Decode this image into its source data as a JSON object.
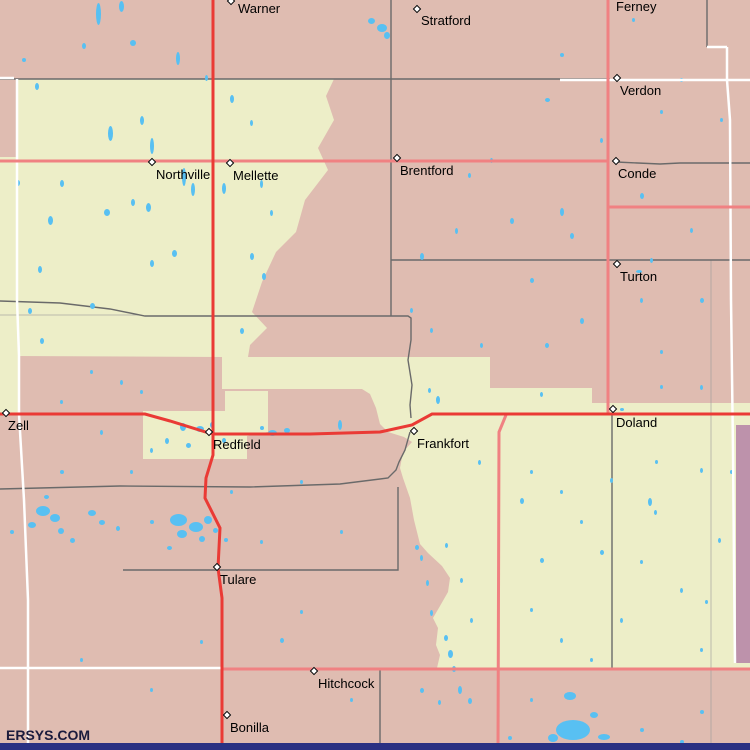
{
  "map": {
    "attribution": "ERSYS.COM",
    "width": 750,
    "height": 750,
    "colors": {
      "base_pink": "#dfbcb1",
      "yellow": "#edeec8",
      "purple": "#bd92ab",
      "water": "#58c0f2",
      "road_major": "#ea3a35",
      "road_secondary": "#f08182",
      "road_minor": "#ffffff",
      "boundary": "#6a6a6a",
      "boundary_faint": "#9a9a9a",
      "bottom_bar": "#2a3183",
      "label_text": "#000000"
    },
    "regions": {
      "yellow_main": "16,79 334,79 326,96 334,120 318,148 328,170 305,200 296,232 276,252 262,282 252,312 267,328 250,345 248,357 490,357 490,388 592,388 592,403 750,403 750,668 437,668 440,655 436,645 438,628 433,618 440,606 448,592 450,578 442,566 428,553 420,544 414,520 410,498 403,478 400,468 403,452 412,442 404,437 388,432 380,424 376,408 370,394 362,389 222,389 222,357 16,356",
      "left_yellow_sliver": "0,157 17,157 17,356 19,356 19,414 0,414",
      "redfield_patch": "143,411 225,411 225,391 268,391 268,432 247,436 247,459 143,459",
      "purple_strip": "736,425 750,425 750,663 736,663"
    },
    "boundaries_gray": [
      "0,79 610,79",
      "391,0 391,316",
      "0,301 60,303 110,309 145,316 408,316 411,318 411,340 408,360 412,385 410,405 411,418",
      "410,432 405,450 399,462 396,470 388,478 340,484 250,487 120,486 0,489",
      "123,570 398,570 398,487",
      "616,162 660,164 680,163 750,163",
      "391,260 750,260",
      "612,414 612,668",
      "380,668 380,750",
      "707,0 707,47"
    ],
    "boundaries_faint": [
      "711,260 711,750",
      "0,315 140,315"
    ],
    "roads_white": [
      "17,79 17,300 19,356 19,414",
      "19,414 24,500 28,600 28,750",
      "0,78 14,78",
      "560,80 750,80",
      "707,47 727,47",
      "727,47 727,80 730,120 731,300 733,450 734,560 735,663",
      "0,668 222,668"
    ],
    "roads_secondary": [
      "0,161 608,161",
      "608,0 608,414",
      "608,207 750,207",
      "506,415 499,432 498,750",
      "222,669 750,669"
    ],
    "roads_major": [
      "213,0 213,300 213,455 206,478 205,498 220,528 218,568 222,598 222,750",
      "0,414 145,414 170,421 209,433 215,434 310,434 380,432 412,425 432,414 610,414 750,414"
    ],
    "lakes": [
      [
        96,
        3,
        5,
        22
      ],
      [
        119,
        1,
        5,
        11
      ],
      [
        176,
        52,
        4,
        13
      ],
      [
        140,
        116,
        4,
        9
      ],
      [
        108,
        126,
        5,
        15
      ],
      [
        150,
        138,
        4,
        16
      ],
      [
        182,
        168,
        4,
        18
      ],
      [
        191,
        183,
        4,
        13
      ],
      [
        222,
        183,
        4,
        11
      ],
      [
        146,
        203,
        5,
        9
      ],
      [
        131,
        199,
        4,
        7
      ],
      [
        104,
        209,
        6,
        7
      ],
      [
        172,
        250,
        5,
        7
      ],
      [
        150,
        260,
        4,
        7
      ],
      [
        48,
        216,
        5,
        9
      ],
      [
        38,
        266,
        4,
        7
      ],
      [
        60,
        180,
        4,
        7
      ],
      [
        16,
        180,
        4,
        6
      ],
      [
        35,
        83,
        4,
        7
      ],
      [
        82,
        43,
        4,
        6
      ],
      [
        130,
        40,
        6,
        6
      ],
      [
        250,
        253,
        4,
        7
      ],
      [
        262,
        273,
        4,
        7
      ],
      [
        240,
        328,
        4,
        6
      ],
      [
        90,
        303,
        5,
        6
      ],
      [
        40,
        338,
        4,
        6
      ],
      [
        28,
        308,
        4,
        6
      ],
      [
        230,
        95,
        4,
        8
      ],
      [
        250,
        120,
        3,
        6
      ],
      [
        205,
        75,
        3,
        6
      ],
      [
        260,
        180,
        3,
        8
      ],
      [
        270,
        210,
        3,
        6
      ],
      [
        368,
        18,
        7,
        6
      ],
      [
        377,
        24,
        10,
        8
      ],
      [
        384,
        32,
        6,
        7
      ],
      [
        545,
        98,
        5,
        4
      ],
      [
        560,
        53,
        4,
        4
      ],
      [
        22,
        58,
        4,
        4
      ],
      [
        420,
        253,
        4,
        7
      ],
      [
        455,
        228,
        3,
        6
      ],
      [
        468,
        173,
        3,
        5
      ],
      [
        510,
        218,
        4,
        6
      ],
      [
        560,
        208,
        4,
        8
      ],
      [
        570,
        233,
        4,
        6
      ],
      [
        530,
        278,
        4,
        5
      ],
      [
        490,
        158,
        3,
        5
      ],
      [
        600,
        138,
        3,
        5
      ],
      [
        640,
        193,
        4,
        6
      ],
      [
        650,
        258,
        3,
        5
      ],
      [
        690,
        228,
        3,
        5
      ],
      [
        700,
        298,
        4,
        5
      ],
      [
        720,
        118,
        3,
        4
      ],
      [
        680,
        78,
        3,
        4
      ],
      [
        640,
        298,
        3,
        5
      ],
      [
        580,
        318,
        4,
        6
      ],
      [
        545,
        343,
        4,
        5
      ],
      [
        480,
        343,
        3,
        5
      ],
      [
        430,
        328,
        3,
        5
      ],
      [
        410,
        308,
        3,
        5
      ],
      [
        632,
        18,
        3,
        4
      ],
      [
        660,
        110,
        3,
        4
      ],
      [
        636,
        270,
        6,
        3
      ],
      [
        700,
        385,
        3,
        5
      ],
      [
        660,
        350,
        3,
        4
      ],
      [
        338,
        420,
        4,
        10
      ],
      [
        436,
        396,
        4,
        8
      ],
      [
        428,
        388,
        3,
        5
      ],
      [
        180,
        423,
        6,
        8
      ],
      [
        196,
        426,
        8,
        6
      ],
      [
        210,
        422,
        4,
        6
      ],
      [
        165,
        438,
        4,
        6
      ],
      [
        150,
        448,
        3,
        5
      ],
      [
        186,
        443,
        5,
        5
      ],
      [
        222,
        438,
        4,
        5
      ],
      [
        268,
        430,
        9,
        6
      ],
      [
        284,
        428,
        6,
        5
      ],
      [
        260,
        426,
        4,
        4
      ],
      [
        540,
        392,
        3,
        5
      ],
      [
        620,
        408,
        4,
        3
      ],
      [
        660,
        385,
        3,
        4
      ],
      [
        36,
        506,
        14,
        10
      ],
      [
        50,
        514,
        10,
        8
      ],
      [
        28,
        522,
        8,
        6
      ],
      [
        58,
        528,
        6,
        6
      ],
      [
        88,
        510,
        8,
        6
      ],
      [
        99,
        520,
        6,
        5
      ],
      [
        70,
        538,
        5,
        5
      ],
      [
        116,
        526,
        4,
        5
      ],
      [
        10,
        530,
        4,
        4
      ],
      [
        44,
        495,
        5,
        4
      ],
      [
        170,
        514,
        17,
        12
      ],
      [
        189,
        522,
        14,
        10
      ],
      [
        204,
        516,
        8,
        8
      ],
      [
        177,
        530,
        10,
        8
      ],
      [
        199,
        536,
        6,
        6
      ],
      [
        213,
        528,
        5,
        5
      ],
      [
        224,
        538,
        4,
        4
      ],
      [
        167,
        546,
        5,
        4
      ],
      [
        150,
        520,
        4,
        4
      ],
      [
        520,
        498,
        4,
        6
      ],
      [
        540,
        558,
        4,
        5
      ],
      [
        610,
        478,
        3,
        5
      ],
      [
        648,
        498,
        4,
        8
      ],
      [
        654,
        510,
        3,
        5
      ],
      [
        700,
        468,
        3,
        5
      ],
      [
        718,
        538,
        3,
        5
      ],
      [
        680,
        588,
        3,
        5
      ],
      [
        620,
        618,
        3,
        5
      ],
      [
        560,
        638,
        3,
        5
      ],
      [
        530,
        608,
        3,
        4
      ],
      [
        590,
        658,
        3,
        4
      ],
      [
        700,
        648,
        3,
        4
      ],
      [
        460,
        578,
        3,
        5
      ],
      [
        470,
        618,
        3,
        5
      ],
      [
        445,
        543,
        3,
        5
      ],
      [
        478,
        460,
        3,
        5
      ],
      [
        530,
        470,
        3,
        4
      ],
      [
        580,
        520,
        3,
        4
      ],
      [
        640,
        560,
        3,
        4
      ],
      [
        705,
        600,
        3,
        4
      ],
      [
        730,
        470,
        3,
        4
      ],
      [
        560,
        490,
        3,
        4
      ],
      [
        600,
        550,
        4,
        5
      ],
      [
        655,
        460,
        3,
        4
      ],
      [
        448,
        650,
        5,
        8
      ],
      [
        452,
        666,
        4,
        6
      ],
      [
        458,
        686,
        4,
        8
      ],
      [
        468,
        698,
        4,
        6
      ],
      [
        444,
        635,
        4,
        6
      ],
      [
        438,
        700,
        3,
        5
      ],
      [
        430,
        610,
        3,
        6
      ],
      [
        426,
        580,
        3,
        6
      ],
      [
        420,
        555,
        3,
        6
      ],
      [
        415,
        545,
        4,
        5
      ],
      [
        556,
        720,
        34,
        20
      ],
      [
        564,
        692,
        12,
        8
      ],
      [
        590,
        712,
        8,
        6
      ],
      [
        548,
        734,
        10,
        8
      ],
      [
        598,
        734,
        12,
        6
      ],
      [
        640,
        728,
        4,
        4
      ],
      [
        700,
        710,
        4,
        4
      ],
      [
        530,
        698,
        3,
        4
      ],
      [
        615,
        743,
        4,
        4
      ],
      [
        280,
        638,
        4,
        5
      ],
      [
        350,
        698,
        3,
        4
      ],
      [
        150,
        688,
        3,
        4
      ],
      [
        80,
        658,
        3,
        4
      ],
      [
        420,
        688,
        4,
        5
      ],
      [
        508,
        736,
        4,
        4
      ],
      [
        680,
        740,
        4,
        4
      ],
      [
        120,
        380,
        3,
        5
      ],
      [
        90,
        370,
        3,
        4
      ],
      [
        60,
        400,
        3,
        4
      ],
      [
        140,
        390,
        3,
        4
      ],
      [
        100,
        430,
        3,
        5
      ],
      [
        60,
        470,
        4,
        4
      ],
      [
        130,
        470,
        3,
        4
      ],
      [
        230,
        490,
        3,
        4
      ],
      [
        300,
        480,
        3,
        4
      ],
      [
        340,
        530,
        3,
        4
      ],
      [
        260,
        540,
        3,
        4
      ],
      [
        300,
        610,
        3,
        4
      ],
      [
        200,
        640,
        3,
        4
      ]
    ],
    "towns": [
      {
        "name": "Warner",
        "marker": [
          231,
          1
        ],
        "label": [
          238,
          2
        ]
      },
      {
        "name": "Stratford",
        "marker": [
          417,
          9
        ],
        "label": [
          421,
          14
        ]
      },
      {
        "name": "Ferney",
        "marker": null,
        "label": [
          616,
          0
        ]
      },
      {
        "name": "Verdon",
        "marker": [
          617,
          78
        ],
        "label": [
          620,
          84
        ]
      },
      {
        "name": "Northville",
        "marker": [
          152,
          162
        ],
        "label": [
          156,
          168
        ]
      },
      {
        "name": "Mellette",
        "marker": [
          230,
          163
        ],
        "label": [
          233,
          169
        ]
      },
      {
        "name": "Brentford",
        "marker": [
          397,
          158
        ],
        "label": [
          400,
          164
        ]
      },
      {
        "name": "Conde",
        "marker": [
          616,
          161
        ],
        "label": [
          618,
          167
        ]
      },
      {
        "name": "Turton",
        "marker": [
          617,
          264
        ],
        "label": [
          620,
          270
        ]
      },
      {
        "name": "Zell",
        "marker": [
          6,
          413
        ],
        "label": [
          8,
          419
        ]
      },
      {
        "name": "Redfield",
        "marker": [
          209,
          432
        ],
        "label": [
          213,
          438
        ]
      },
      {
        "name": "Frankfort",
        "marker": [
          414,
          431
        ],
        "label": [
          417,
          437
        ]
      },
      {
        "name": "Doland",
        "marker": [
          613,
          409
        ],
        "label": [
          616,
          416
        ]
      },
      {
        "name": "Tulare",
        "marker": [
          217,
          567
        ],
        "label": [
          220,
          573
        ]
      },
      {
        "name": "Hitchcock",
        "marker": [
          314,
          671
        ],
        "label": [
          318,
          677
        ]
      },
      {
        "name": "Bonilla",
        "marker": [
          227,
          715
        ],
        "label": [
          230,
          721
        ]
      }
    ]
  }
}
